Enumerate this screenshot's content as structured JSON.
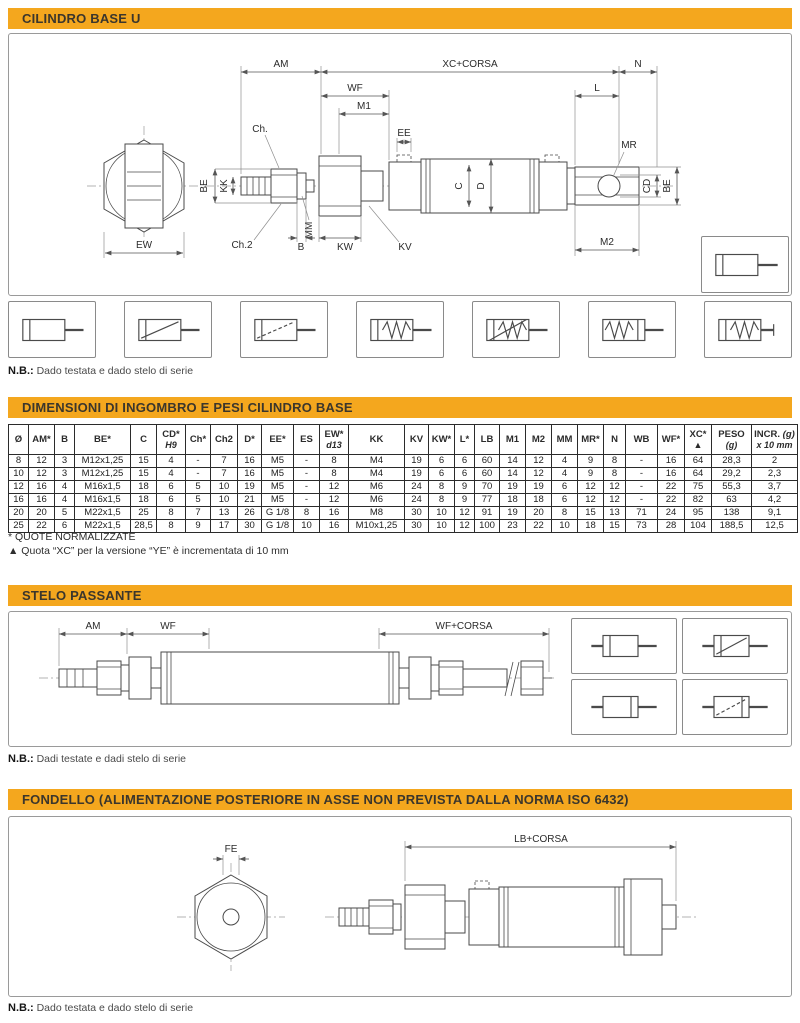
{
  "colors": {
    "accent": "#F4A71E",
    "bar_text": "#3B362C",
    "line": "#4A4A4A"
  },
  "bars": {
    "base": "CILINDRO BASE U",
    "dimensions": "DIMENSIONI DI INGOMBRO E PESI CILINDRO BASE",
    "stelo": "STELO PASSANTE",
    "fondello": "FONDELLO (ALIMENTAZIONE POSTERIORE IN ASSE NON PREVISTA DALLA NORMA ISO 6432)"
  },
  "notes": {
    "prefix": "N.B.:",
    "base": "Dado testata e dado stelo di serie",
    "stelo": "Dadi testate e dadi stelo di serie",
    "fondello": "Dado testata e dado stelo di serie"
  },
  "footnotes": {
    "normalized": "* QUOTE NORMALIZZATE",
    "xc": "▲ Quota “XC” per la versione “YE” è incrementata di 10 mm"
  },
  "drawing": {
    "base": {
      "am": "AM",
      "xc": "XC+CORSA",
      "n": "N",
      "wf": "WF",
      "l": "L",
      "ch": "Ch.",
      "m1": "M1",
      "ee": "EE",
      "mr": "MR",
      "be_left": "BE",
      "kk": "KK",
      "mm": "MM",
      "c": "C",
      "d": "D",
      "cd": "CD",
      "be_right": "BE",
      "ew": "EW",
      "ch2": "Ch.2",
      "b": "B",
      "kw": "KW",
      "kv": "KV",
      "m2": "M2"
    },
    "stelo": {
      "am": "AM",
      "wf": "WF",
      "wf_corsa": "WF+CORSA"
    },
    "fondello": {
      "fe": "FE",
      "lb_corsa": "LB+CORSA"
    }
  },
  "table": {
    "headers": [
      {
        "t": "Ø"
      },
      {
        "t": "AM*"
      },
      {
        "t": "B"
      },
      {
        "t": "BE*"
      },
      {
        "t": "C"
      },
      {
        "t": "CD*",
        "b": "H9",
        "bi": true
      },
      {
        "t": "Ch*"
      },
      {
        "t": "Ch2"
      },
      {
        "t": "D*"
      },
      {
        "t": "EE*"
      },
      {
        "t": "ES"
      },
      {
        "t": "EW*",
        "b": "d13",
        "bi": true
      },
      {
        "t": "KK"
      },
      {
        "t": "KV"
      },
      {
        "t": "KW*"
      },
      {
        "t": "L*"
      },
      {
        "t": "LB"
      },
      {
        "t": "M1"
      },
      {
        "t": "M2"
      },
      {
        "t": "MM"
      },
      {
        "t": "MR*"
      },
      {
        "t": "N"
      },
      {
        "t": "WB"
      },
      {
        "t": "WF*"
      },
      {
        "t": "XC*",
        "b": "▲"
      },
      {
        "t": "PESO",
        "b": "(g)",
        "bi": true
      },
      {
        "t": "INCR.",
        "t2": "(g)",
        "b": "x 10 mm",
        "bi": true
      }
    ],
    "rows": [
      [
        "8",
        "12",
        "3",
        "M12x1,25",
        "15",
        "4",
        "-",
        "7",
        "16",
        "M5",
        "-",
        "8",
        "M4",
        "19",
        "6",
        "6",
        "60",
        "14",
        "12",
        "4",
        "9",
        "8",
        "-",
        "16",
        "64",
        "28,3",
        "2"
      ],
      [
        "10",
        "12",
        "3",
        "M12x1,25",
        "15",
        "4",
        "-",
        "7",
        "16",
        "M5",
        "-",
        "8",
        "M4",
        "19",
        "6",
        "6",
        "60",
        "14",
        "12",
        "4",
        "9",
        "8",
        "-",
        "16",
        "64",
        "29,2",
        "2,3"
      ],
      [
        "12",
        "16",
        "4",
        "M16x1,5",
        "18",
        "6",
        "5",
        "10",
        "19",
        "M5",
        "-",
        "12",
        "M6",
        "24",
        "8",
        "9",
        "70",
        "19",
        "19",
        "6",
        "12",
        "12",
        "-",
        "22",
        "75",
        "55,3",
        "3,7"
      ],
      [
        "16",
        "16",
        "4",
        "M16x1,5",
        "18",
        "6",
        "5",
        "10",
        "21",
        "M5",
        "-",
        "12",
        "M6",
        "24",
        "8",
        "9",
        "77",
        "18",
        "18",
        "6",
        "12",
        "12",
        "-",
        "22",
        "82",
        "63",
        "4,2"
      ],
      [
        "20",
        "20",
        "5",
        "M22x1,5",
        "25",
        "8",
        "7",
        "13",
        "26",
        "G 1/8",
        "8",
        "16",
        "M8",
        "30",
        "10",
        "12",
        "91",
        "19",
        "20",
        "8",
        "15",
        "13",
        "71",
        "24",
        "95",
        "138",
        "9,1"
      ],
      [
        "25",
        "22",
        "6",
        "M22x1,5",
        "28,5",
        "8",
        "9",
        "17",
        "30",
        "G 1/8",
        "10",
        "16",
        "M10x1,25",
        "30",
        "10",
        "12",
        "100",
        "23",
        "22",
        "10",
        "18",
        "15",
        "73",
        "28",
        "104",
        "188,5",
        "12,5"
      ]
    ]
  },
  "variants": {
    "base_row": [
      {
        "name": "cylinder-double-acting-icon",
        "type": "da"
      },
      {
        "name": "cylinder-double-acting-diag-icon",
        "type": "da-diag"
      },
      {
        "name": "cylinder-double-acting-diag-dashed-icon",
        "type": "da-diag-dash"
      },
      {
        "name": "cylinder-single-acting-spring-icon",
        "type": "sa-spring"
      },
      {
        "name": "cylinder-single-acting-spring-diag-icon",
        "type": "sa-spring-diag"
      },
      {
        "name": "cylinder-spring-front-icon",
        "type": "sa-spring-front"
      },
      {
        "name": "cylinder-spring-rear-icon",
        "type": "sa-spring-rear"
      }
    ],
    "base_extra": [
      {
        "name": "cylinder-plain-rod-icon",
        "type": "da-rod"
      }
    ],
    "stelo_grid": [
      {
        "name": "through-rod-cylinder-icon",
        "type": "thru"
      },
      {
        "name": "through-rod-cylinder-diag-icon",
        "type": "thru-diag"
      },
      {
        "name": "through-rod-cylinder-rear-piston-icon",
        "type": "thru2"
      },
      {
        "name": "through-rod-cylinder-diag-dashed-icon",
        "type": "thru-diag2"
      }
    ]
  }
}
